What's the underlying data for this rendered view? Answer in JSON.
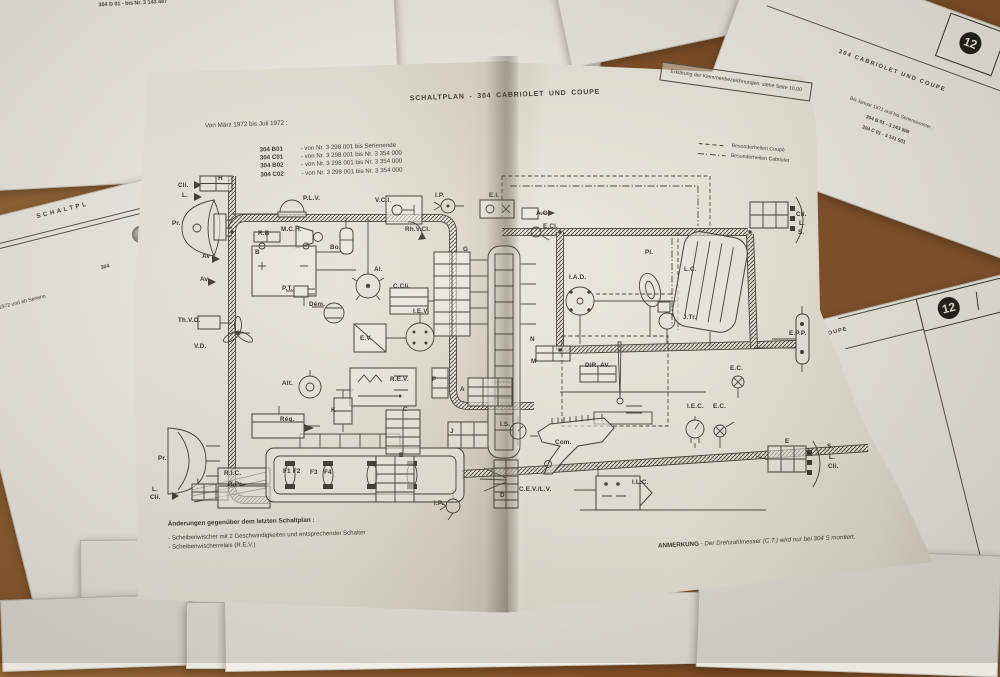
{
  "colors": {
    "table_wood": "#8a5a2e",
    "paper": "#efede6",
    "page_left": "#e9e6da",
    "page_right": "#efecdf",
    "ink": "#3a3831",
    "badge_bg": "#1e1d1a"
  },
  "surrounding_sheets": {
    "top_left": {
      "line1": "304 A 01",
      "line2": "304 D 01  -  bis Nr.  3 143 487"
    },
    "left": {
      "heading": "SCHALTPL",
      "ref": "304",
      "note": "Seit März 1972 und ab Serienn"
    },
    "top_right": {
      "title": "304  CABRIOLET  UND  COUPE",
      "badge": "12",
      "line1": "Bis Januar 1971 und bis Seriennummer :",
      "line2": "304 B 01  -  3 143 508",
      "line3": "304 C 01  -  3 141 501"
    },
    "right_mid": {
      "badge": "12",
      "code_left": "10",
      "code_right": "84",
      "title": "UND  COUPE"
    }
  },
  "booklet": {
    "title": "SCHALTPLAN  -  304  CABRIOLET  UND  COUPE",
    "period": "Von März 1972 bis Juli 1972 :",
    "models": [
      {
        "code": "304 B01",
        "range": "-  von Nr. 3 298 001 bis Serienende"
      },
      {
        "code": "304 C01",
        "range": "-  von Nr. 3 298 001 bis Nr. 3 354 000"
      },
      {
        "code": "304 B02",
        "range": "-  von Nr. 3 298 001 bis Nr. 3 354 000"
      },
      {
        "code": "304 C02",
        "range": "-  von Nr. 3 298 001 bis Nr. 3 354 000"
      }
    ],
    "terminal_note": "Erklärung der Klemmenbezeichnungen: siehe Seite 10.00",
    "legend": [
      {
        "style": "dashed",
        "label": "Besonderheiten Coupé"
      },
      {
        "style": "dashdot",
        "label": "Besonderheiten Cabriolet"
      }
    ],
    "changes_heading": "Änderungen gegenüber dem letzten Schaltplan :",
    "changes": [
      "- Scheibenwischer mit 2 Geschwindigkeiten und entsprechender Schalter",
      "- Scheibenwischerrelais (R.E.V.)"
    ],
    "remark_label": "ANMERKUNG",
    "remark_text": "-  Der Drehzahlmesser (C.T.) wird nur bei 304 S montiert."
  },
  "diagram": {
    "labels": [
      {
        "t": "Cli.",
        "x": 30,
        "y": 108
      },
      {
        "t": "L.",
        "x": 34,
        "y": 118
      },
      {
        "t": "H",
        "x": 70,
        "y": 101
      },
      {
        "t": "P.L.V.",
        "x": 155,
        "y": 121
      },
      {
        "t": "Pr.",
        "x": 24,
        "y": 146
      },
      {
        "t": "M.C.H.",
        "x": 133,
        "y": 152
      },
      {
        "t": "R.B",
        "x": 110,
        "y": 156
      },
      {
        "t": "B",
        "x": 107,
        "y": 175
      },
      {
        "t": "Bo.",
        "x": 182,
        "y": 170
      },
      {
        "t": "Av",
        "x": 54,
        "y": 179
      },
      {
        "t": "Av",
        "x": 52,
        "y": 202
      },
      {
        "t": "Al.",
        "x": 226,
        "y": 192
      },
      {
        "t": "P.T.",
        "x": 134,
        "y": 211
      },
      {
        "t": "Dém.",
        "x": 161,
        "y": 227
      },
      {
        "t": "Th.V.D.",
        "x": 30,
        "y": 243
      },
      {
        "t": "V.D.",
        "x": 46,
        "y": 269
      },
      {
        "t": "E.V.",
        "x": 212,
        "y": 261
      },
      {
        "t": "C.Cli.",
        "x": 245,
        "y": 209
      },
      {
        "t": "I.E.V.",
        "x": 265,
        "y": 234
      },
      {
        "t": "R.E.V.",
        "x": 242,
        "y": 302
      },
      {
        "t": "Alt.",
        "x": 134,
        "y": 306
      },
      {
        "t": "Rég.",
        "x": 132,
        "y": 342
      },
      {
        "t": "K",
        "x": 183,
        "y": 333
      },
      {
        "t": "Pr.",
        "x": 10,
        "y": 381
      },
      {
        "t": "I",
        "x": 49,
        "y": 404
      },
      {
        "t": "R.I.C.",
        "x": 76,
        "y": 396
      },
      {
        "t": "R.Pr.",
        "x": 80,
        "y": 407
      },
      {
        "t": "L.",
        "x": 4,
        "y": 412
      },
      {
        "t": "Cli.",
        "x": 2,
        "y": 420
      },
      {
        "t": "F1 F2",
        "x": 135,
        "y": 394
      },
      {
        "t": "F3",
        "x": 162,
        "y": 395
      },
      {
        "t": "F4",
        "x": 176,
        "y": 395
      },
      {
        "t": "V.C.I.",
        "x": 227,
        "y": 123
      },
      {
        "t": "I.P.",
        "x": 287,
        "y": 118
      },
      {
        "t": "Rh.V.Cl.",
        "x": 257,
        "y": 152
      },
      {
        "t": "E.I.",
        "x": 341,
        "y": 118
      },
      {
        "t": "A.C.",
        "x": 388,
        "y": 136
      },
      {
        "t": "E.Cl.",
        "x": 395,
        "y": 149
      },
      {
        "t": "G",
        "x": 315,
        "y": 172
      },
      {
        "t": "I.A.D.",
        "x": 421,
        "y": 200
      },
      {
        "t": "N",
        "x": 382,
        "y": 262
      },
      {
        "t": "M",
        "x": 383,
        "y": 284
      },
      {
        "t": "DIR. AV.",
        "x": 437,
        "y": 288
      },
      {
        "t": "P",
        "x": 284,
        "y": 302
      },
      {
        "t": "A",
        "x": 312,
        "y": 312
      },
      {
        "t": "C",
        "x": 255,
        "y": 332
      },
      {
        "t": "B",
        "x": 251,
        "y": 378
      },
      {
        "t": "J",
        "x": 302,
        "y": 354
      },
      {
        "t": "I.S.",
        "x": 352,
        "y": 347
      },
      {
        "t": "I.P.",
        "x": 286,
        "y": 426
      },
      {
        "t": "D",
        "x": 352,
        "y": 418
      },
      {
        "t": "Com.",
        "x": 407,
        "y": 365
      },
      {
        "t": "C.E.V./L.V.",
        "x": 371,
        "y": 412
      },
      {
        "t": "I.L.C.",
        "x": 484,
        "y": 405
      },
      {
        "t": "I.E.C.",
        "x": 539,
        "y": 329
      },
      {
        "t": "E.C.",
        "x": 565,
        "y": 329
      },
      {
        "t": "E.C.",
        "x": 582,
        "y": 291
      },
      {
        "t": "Pl.",
        "x": 497,
        "y": 175
      },
      {
        "t": "L.C.",
        "x": 536,
        "y": 192
      },
      {
        "t": "J.Tr.",
        "x": 535,
        "y": 240
      },
      {
        "t": "E.P.P.",
        "x": 641,
        "y": 256
      },
      {
        "t": "E",
        "x": 637,
        "y": 364
      },
      {
        "t": "S.",
        "x": 679,
        "y": 369
      },
      {
        "t": "L.",
        "x": 681,
        "y": 380
      },
      {
        "t": "Cli.",
        "x": 680,
        "y": 389
      },
      {
        "t": "Cli.",
        "x": 648,
        "y": 137
      },
      {
        "t": "L.",
        "x": 651,
        "y": 146
      },
      {
        "t": "S.",
        "x": 650,
        "y": 155
      }
    ]
  }
}
